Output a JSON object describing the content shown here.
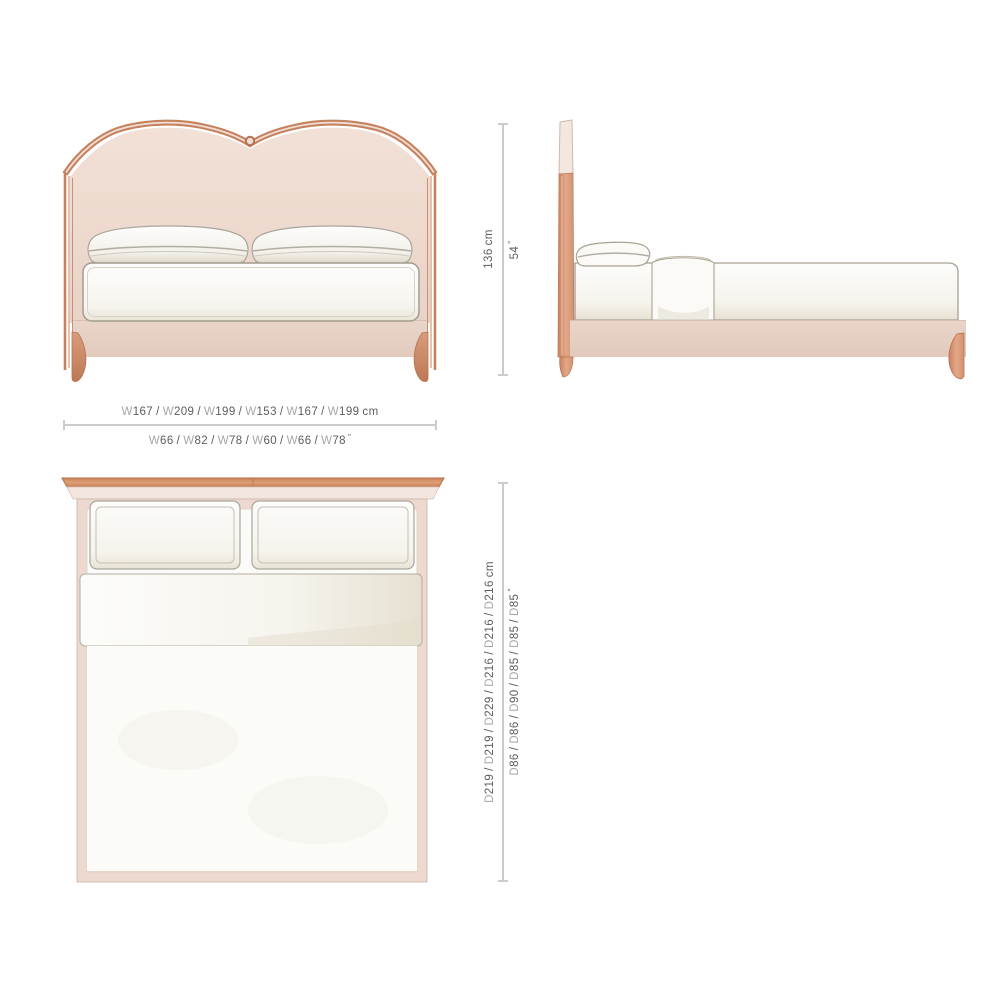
{
  "colors": {
    "wood": "#c5825f",
    "wood_dark": "#a96a4e",
    "wood_light": "#dfa златого886f",
    "upholstery_blush": "#efddd3",
    "base_blush": "#e7d1c6",
    "linen_white": "#fbfbf9",
    "linen_shadow": "#ddd7c9",
    "outline_gray": "#a8a295",
    "dim_line": "#cccccc",
    "dim_value_text": "#5d5d5d",
    "dim_prefix_text": "#a6a6a6"
  },
  "dimensions": {
    "width_cm": {
      "items": [
        {
          "prefix": "W",
          "value": "167"
        },
        {
          "prefix": "W",
          "value": "209"
        },
        {
          "prefix": "W",
          "value": "199"
        },
        {
          "prefix": "W",
          "value": "153"
        },
        {
          "prefix": "W",
          "value": "167"
        },
        {
          "prefix": "W",
          "value": "199"
        }
      ],
      "unit": "cm"
    },
    "width_in": {
      "items": [
        {
          "prefix": "W",
          "value": "66"
        },
        {
          "prefix": "W",
          "value": "82"
        },
        {
          "prefix": "W",
          "value": "78"
        },
        {
          "prefix": "W",
          "value": "60"
        },
        {
          "prefix": "W",
          "value": "66"
        },
        {
          "prefix": "W",
          "value": "78"
        }
      ],
      "unit": "″",
      "unit_style": "inch"
    },
    "height_cm": {
      "items": [
        {
          "prefix": "",
          "value": "136"
        }
      ],
      "unit": "cm"
    },
    "height_in": {
      "items": [
        {
          "prefix": "",
          "value": "54"
        }
      ],
      "unit": "″",
      "unit_style": "inch"
    },
    "depth_cm": {
      "items": [
        {
          "prefix": "D",
          "value": "219"
        },
        {
          "prefix": "D",
          "value": "219"
        },
        {
          "prefix": "D",
          "value": "229"
        },
        {
          "prefix": "D",
          "value": "216"
        },
        {
          "prefix": "D",
          "value": "216"
        },
        {
          "prefix": "D",
          "value": "216"
        }
      ],
      "unit": "cm"
    },
    "depth_in": {
      "items": [
        {
          "prefix": "D",
          "value": "86"
        },
        {
          "prefix": "D",
          "value": "86"
        },
        {
          "prefix": "D",
          "value": "90"
        },
        {
          "prefix": "D",
          "value": "85"
        },
        {
          "prefix": "D",
          "value": "85"
        },
        {
          "prefix": "D",
          "value": "85"
        }
      ],
      "unit": "″",
      "unit_style": "inch"
    }
  }
}
